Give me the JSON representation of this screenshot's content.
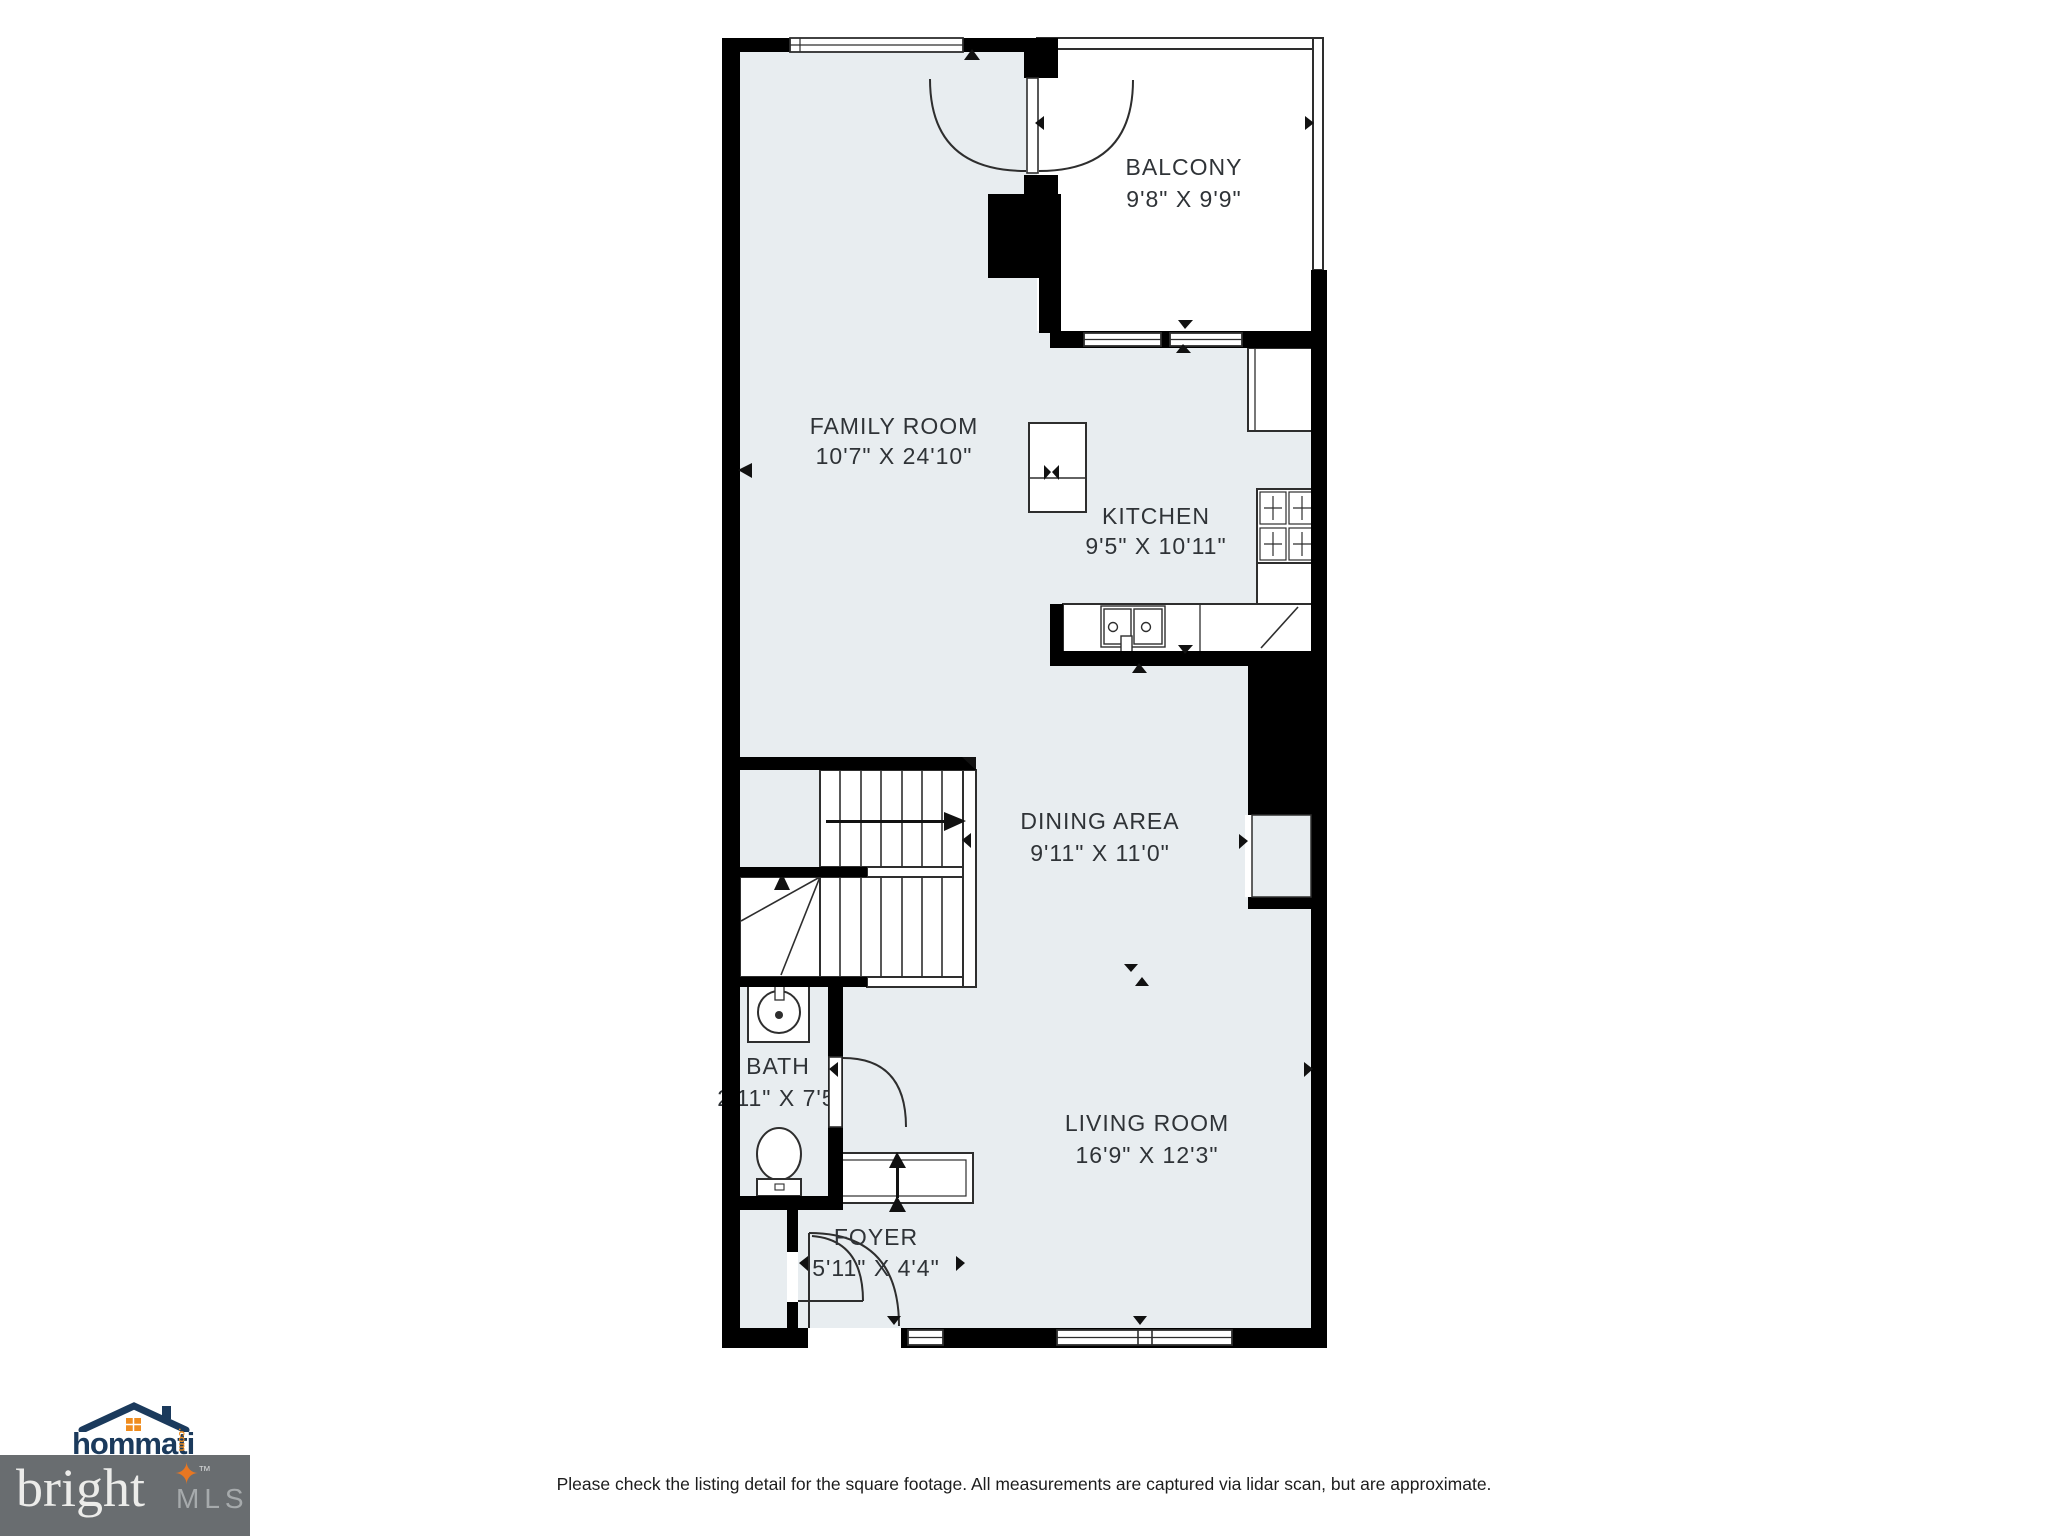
{
  "plan": {
    "rooms": [
      {
        "id": "balcony",
        "name": "BALCONY",
        "dims": "9'8\" X 9'9\""
      },
      {
        "id": "family-room",
        "name": "FAMILY ROOM",
        "dims": "10'7\" X 24'10\""
      },
      {
        "id": "kitchen",
        "name": "KITCHEN",
        "dims": "9'5\" X 10'11\""
      },
      {
        "id": "dining-area",
        "name": "DINING AREA",
        "dims": "9'11\" X 11'0\""
      },
      {
        "id": "bath",
        "name": "BATH",
        "dims": "2'11\" X 7'5\""
      },
      {
        "id": "living-room",
        "name": "LIVING ROOM",
        "dims": "16'9\" X 12'3\""
      },
      {
        "id": "foyer",
        "name": "FOYER",
        "dims": "5'11\" X 4'4\""
      }
    ]
  },
  "footer": {
    "disclaimer": "Please check the listing detail for the square footage. All measurements are captured via lidar scan, but are approximate.",
    "hommati": {
      "name": "hommati",
      "tld": ".com"
    },
    "bright": {
      "name": "bright",
      "suffix": "MLS",
      "tm": "™",
      "star": "✦"
    }
  },
  "colors": {
    "floor": "#e8edf0",
    "wall": "#000000",
    "line": "#2e2e2e",
    "accent_orange": "#e87722",
    "brand_navy": "#1b3a5c",
    "bright_box_gray": "#696d70"
  }
}
